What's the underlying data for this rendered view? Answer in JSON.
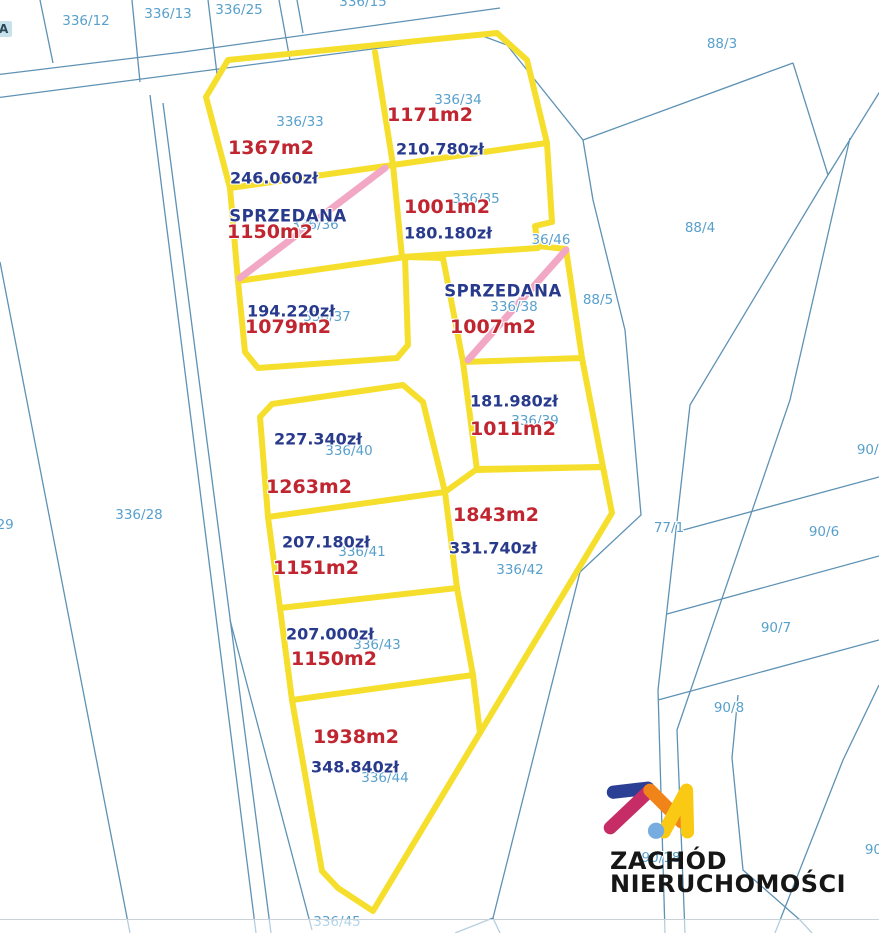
{
  "branding": {
    "name_line1": "ZACHÓD",
    "name_line2": "NIERUCHOMOŚCI"
  },
  "marker": {
    "label": "A"
  },
  "colors": {
    "boundary_blue": "#5E92B4",
    "label_blue": "#58A0CC",
    "area_red": "#C02530",
    "price_navy": "#283A8C",
    "estate_yellow": "#F6DF2C",
    "sold_pink": "#F2A8C5",
    "marker_bg": "#C8E2EC",
    "logo_navy": "#2B3F94",
    "logo_magenta": "#C62D66",
    "logo_orange": "#F08418",
    "logo_yellow": "#F9C913",
    "logo_dot": "#76ACDF",
    "logo_text": "#161616"
  },
  "map": {
    "background_parcels": [
      {
        "id": "336/12",
        "x": 86,
        "y": 21
      },
      {
        "id": "336/13",
        "x": 168,
        "y": 14
      },
      {
        "id": "336/25",
        "x": 239,
        "y": 10
      },
      {
        "id": "336/15",
        "x": 363,
        "y": 2
      },
      {
        "id": "88/3",
        "x": 722,
        "y": 44
      },
      {
        "id": "88/4",
        "x": 700,
        "y": 228
      },
      {
        "id": "88/5",
        "x": 598,
        "y": 300
      },
      {
        "id": "36/46",
        "x": 551,
        "y": 240
      },
      {
        "id": "77/1",
        "x": 669,
        "y": 528
      },
      {
        "id": "90/5",
        "x": 872,
        "y": 450
      },
      {
        "id": "90/6",
        "x": 824,
        "y": 532
      },
      {
        "id": "90/7",
        "x": 776,
        "y": 628
      },
      {
        "id": "90/8",
        "x": 729,
        "y": 708
      },
      {
        "id": "90/18",
        "x": 661,
        "y": 858
      },
      {
        "id": "90/1",
        "x": 880,
        "y": 850
      },
      {
        "id": "336/28",
        "x": 139,
        "y": 515
      },
      {
        "id": "336/29",
        "x": -10,
        "y": 525
      },
      {
        "id": "336/45",
        "x": 337,
        "y": 922
      }
    ],
    "listings": [
      {
        "parcel_id": "336/33",
        "id_pos": [
          300,
          122
        ],
        "area": "1367m2",
        "area_pos": [
          271,
          148
        ],
        "price": "246.060zł",
        "price_pos": [
          274,
          178
        ]
      },
      {
        "parcel_id": "336/34",
        "id_pos": [
          458,
          100
        ],
        "area": "1171m2",
        "area_pos": [
          430,
          115
        ],
        "price": "210.780zł",
        "price_pos": [
          440,
          149
        ]
      },
      {
        "parcel_id": "336/35",
        "id_pos": [
          476,
          199
        ],
        "area": "1001m2",
        "area_pos": [
          447,
          207
        ],
        "price": "180.180zł",
        "price_pos": [
          448,
          233
        ]
      },
      {
        "parcel_id": "336/36",
        "id_pos": [
          315,
          225
        ],
        "area": "1150m2",
        "area_pos": [
          270,
          232
        ],
        "status": "SPRZEDANA",
        "status_pos": [
          288,
          216
        ]
      },
      {
        "parcel_id": "336/37",
        "id_pos": [
          327,
          317
        ],
        "area": "1079m2",
        "area_pos": [
          288,
          327
        ],
        "price": "194.220zł",
        "price_pos": [
          291,
          311
        ]
      },
      {
        "parcel_id": "336/38",
        "id_pos": [
          514,
          307
        ],
        "area": "1007m2",
        "area_pos": [
          493,
          327
        ],
        "status": "SPRZEDANA",
        "status_pos": [
          503,
          291
        ]
      },
      {
        "parcel_id": "336/39",
        "id_pos": [
          535,
          421
        ],
        "area": "1011m2",
        "area_pos": [
          513,
          429
        ],
        "price": "181.980zł",
        "price_pos": [
          514,
          401
        ]
      },
      {
        "parcel_id": "336/40",
        "id_pos": [
          349,
          451
        ],
        "area": "1263m2",
        "area_pos": [
          309,
          487
        ],
        "price": "227.340zł",
        "price_pos": [
          318,
          439
        ]
      },
      {
        "parcel_id": "336/41",
        "id_pos": [
          362,
          552
        ],
        "area": "1151m2",
        "area_pos": [
          316,
          568
        ],
        "price": "207.180zł",
        "price_pos": [
          326,
          542
        ]
      },
      {
        "parcel_id": "336/42",
        "id_pos": [
          520,
          570
        ],
        "area": "1843m2",
        "area_pos": [
          496,
          515
        ],
        "price": "331.740zł",
        "price_pos": [
          493,
          548
        ]
      },
      {
        "parcel_id": "336/43",
        "id_pos": [
          377,
          645
        ],
        "area": "1150m2",
        "area_pos": [
          334,
          659
        ],
        "price": "207.000zł",
        "price_pos": [
          330,
          634
        ]
      },
      {
        "parcel_id": "336/44",
        "id_pos": [
          385,
          778
        ],
        "area": "1938m2",
        "area_pos": [
          356,
          737
        ],
        "price": "348.840zł",
        "price_pos": [
          355,
          767
        ]
      }
    ]
  }
}
